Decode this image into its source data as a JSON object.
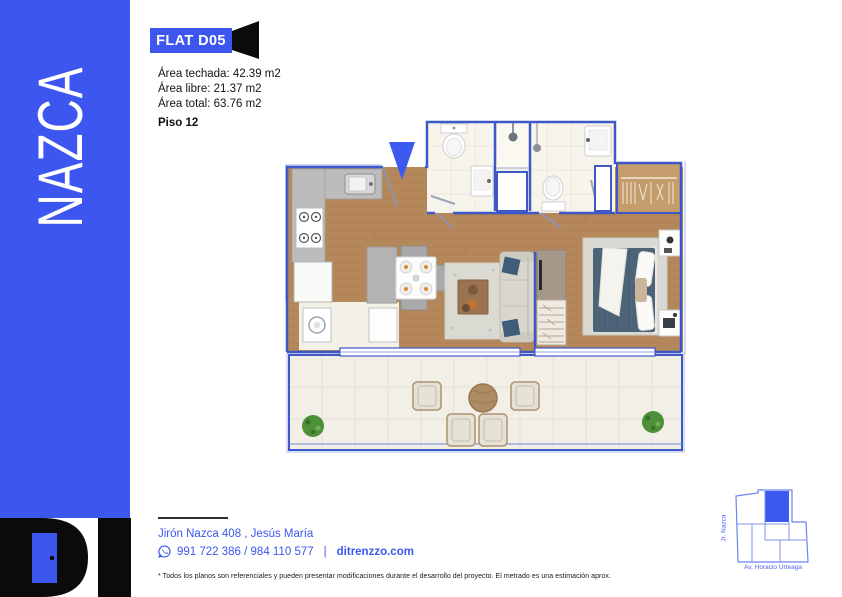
{
  "brand": {
    "sidebar_name": "NAZCA",
    "logo_text": "DI"
  },
  "unit": {
    "badge_label": "FLAT D05",
    "floor_label": "Piso 12",
    "areas": [
      {
        "label": "Área techada:",
        "value": "42.39 m2"
      },
      {
        "label": "Área libre:",
        "value": "21.37 m2"
      },
      {
        "label": "Área total:",
        "value": "63.76 m2"
      }
    ]
  },
  "contact": {
    "address": "Jirón Nazca 408 , Jesús María",
    "phone_numbers": "991 722 386 / 984 110 577",
    "divider": "|",
    "website": "ditrenzzo.com"
  },
  "disclaimer": "* Todos los planos son referenciales y pueden presentar modificaciones durante el desarrollo del proyecto. El metrado es una estimación aprox.",
  "map": {
    "street_vertical": "Jr. Nazca",
    "street_horizontal": "Av. Horacio Urteaga"
  },
  "colors": {
    "accent_blue": "#3d56f0",
    "wall_stroke": "#3f58c8",
    "wood_floor": "#b5885c",
    "bath_floor": "#f7f4ec",
    "terrace_floor": "#f2efe6",
    "logo_black": "#0b0b0b"
  }
}
